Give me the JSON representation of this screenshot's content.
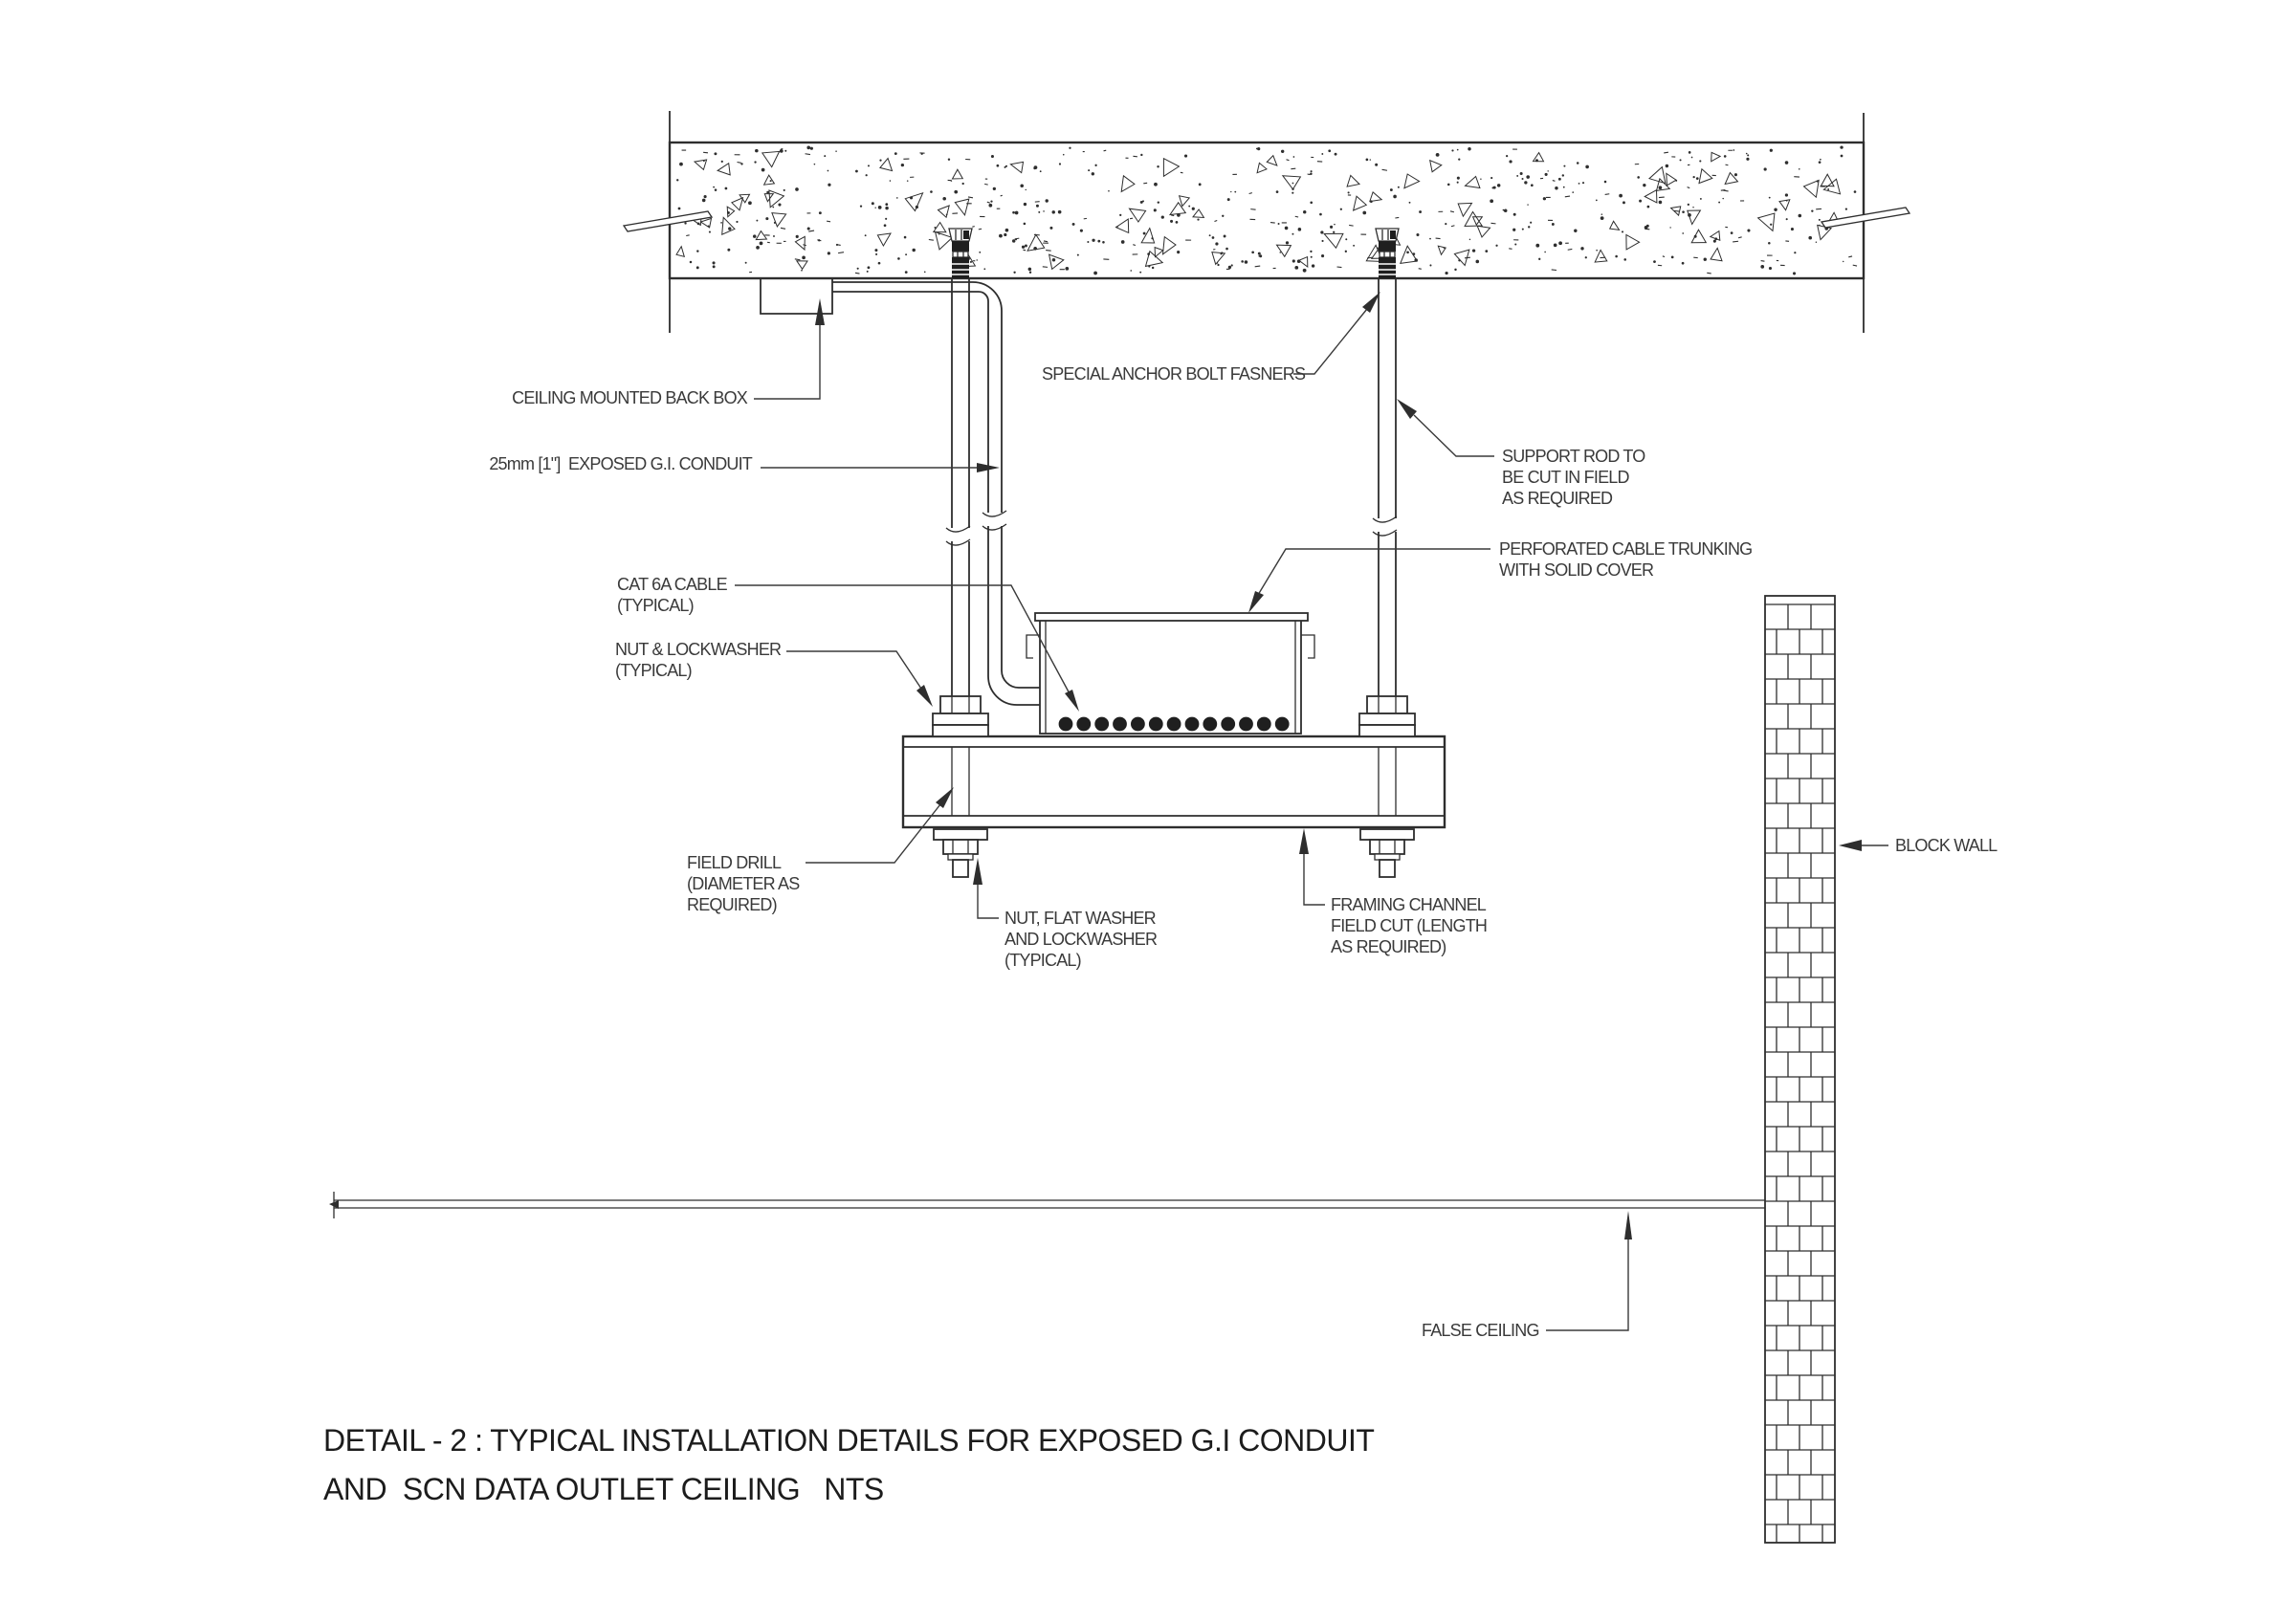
{
  "title": {
    "line1": "DETAIL - 2 : TYPICAL INSTALLATION DETAILS FOR EXPOSED G.I CONDUIT",
    "line2": "AND  SCN DATA OUTLET CEILING   NTS"
  },
  "annotations": {
    "back_box": "CEILING MOUNTED BACK BOX",
    "conduit": "25mm [1\"]  EXPOSED G.I. CONDUIT",
    "cat6a_1": "CAT 6A CABLE",
    "cat6a_2": "(TYPICAL)",
    "nut_lockwasher_1": "NUT & LOCKWASHER",
    "nut_lockwasher_2": "(TYPICAL)",
    "field_drill_1": "FIELD DRILL",
    "field_drill_2": "(DIAMETER AS",
    "field_drill_3": "REQUIRED)",
    "nut_flat_1": "NUT, FLAT WASHER",
    "nut_flat_2": "AND LOCKWASHER",
    "nut_flat_3": "(TYPICAL)",
    "framing_1": "FRAMING CHANNEL",
    "framing_2": "FIELD CUT (LENGTH",
    "framing_3": "AS REQUIRED)",
    "special_anchor": "SPECIAL ANCHOR BOLT FASNERS",
    "support_rod_1": "SUPPORT ROD TO",
    "support_rod_2": "BE CUT IN FIELD",
    "support_rod_3": "AS REQUIRED",
    "trunking_1": "PERFORATED CABLE TRUNKING",
    "trunking_2": "WITH SOLID COVER",
    "block_wall": "BLOCK WALL",
    "false_ceiling": "FALSE CEILING"
  },
  "colors": {
    "line": "#2e2e2e",
    "text": "#3a3a3a",
    "background": "#ffffff"
  }
}
